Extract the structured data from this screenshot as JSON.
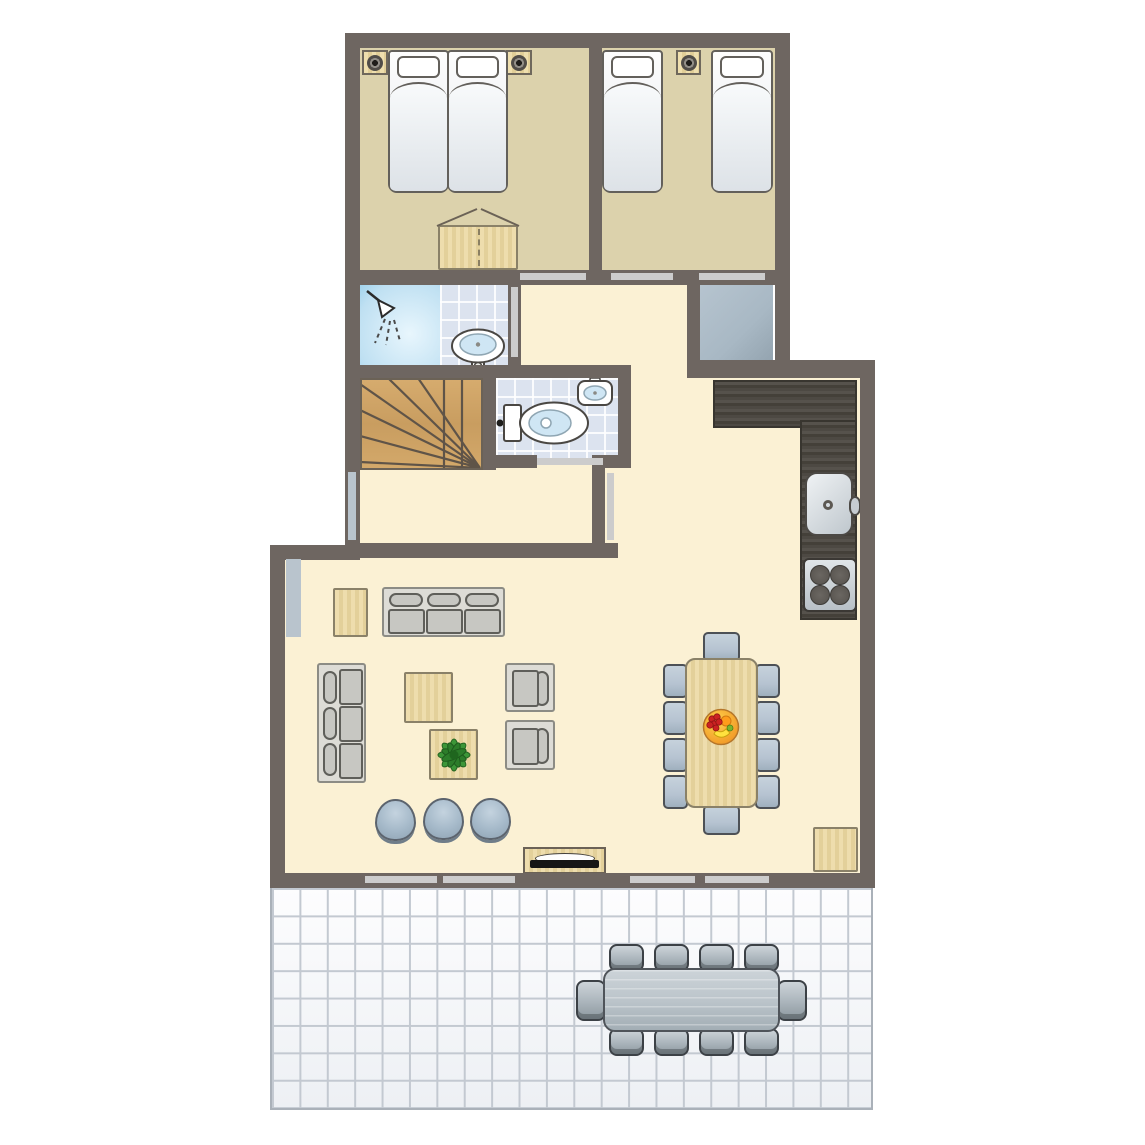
{
  "meta": {
    "title": "Holiday home ground-floor plan",
    "floor": "ground floor",
    "style": "top-down 2D architectural plan"
  },
  "colors": {
    "wall": "#6e6661",
    "floorBedroom": "#dcd2ac",
    "floorLiving": "#fbf1d4",
    "floorCloset": "#a8b8c4",
    "tile": "#dce3ef",
    "shower": "#bfe0f2",
    "woodLight": "#e9d9a7",
    "stairWood": "#cfa566",
    "counterDark": "#474440",
    "chairBlue": "#b6c3d1",
    "pouf": "#a5b9c9",
    "opening": "#cccccc",
    "window": "#b9c4cd",
    "patioLine": "#c3c9d1",
    "outdoorTable": "#bcc5cb",
    "outdoorChair": "#aab4bb",
    "plantGreen": "#3c9638",
    "fruitOrange": "#ef8f1f",
    "tvBlack": "#161616"
  },
  "rooms": {
    "bedroom1": {
      "name": "bedroom-1 (double bed)"
    },
    "bedroom2": {
      "name": "bedroom-2 (two single beds)"
    },
    "bathroom": {
      "name": "shower-room"
    },
    "toilet": {
      "name": "toilet-room"
    },
    "closet": {
      "name": "storage-closet"
    },
    "hallway": {
      "name": "hallway"
    },
    "landing": {
      "name": "stair-landing"
    },
    "stairs": {
      "name": "winder-staircase"
    },
    "kitchen": {
      "name": "kitchen"
    },
    "living": {
      "name": "living-room"
    },
    "dining": {
      "name": "dining-area"
    },
    "terrace": {
      "name": "tiled-terrace"
    }
  },
  "furniture": {
    "bedroom1": [
      "double-bed (2 mattresses)",
      "nightstand-with-lamp",
      "nightstand-with-lamp",
      "wardrobe-with-open-doors"
    ],
    "bedroom2": [
      "single-bed",
      "single-bed",
      "nightstand-with-lamp"
    ],
    "bathroom": [
      "shower-cabin",
      "washbasin"
    ],
    "toilet": [
      "toilet",
      "hand-basin"
    ],
    "kitchen": [
      "l-shaped-counter",
      "kitchen-sink",
      "stove-4-burners"
    ],
    "living": [
      "sofa-3-seat-top",
      "sofa-3-seat-left",
      "armchair",
      "armchair",
      "coffee-table",
      "plant-table",
      "side-table",
      "pouf",
      "pouf",
      "pouf",
      "tv-sideboard"
    ],
    "dining": [
      "dining-table",
      "dining-chair x10",
      "fruit-bowl",
      "corner-cabinet"
    ],
    "terrace": [
      "outdoor-dining-table",
      "outdoor-chair x10"
    ]
  },
  "counts": {
    "dining_chairs": 10,
    "outdoor_chairs": 10,
    "poufs": 3,
    "beds": 4,
    "burners": 4
  }
}
